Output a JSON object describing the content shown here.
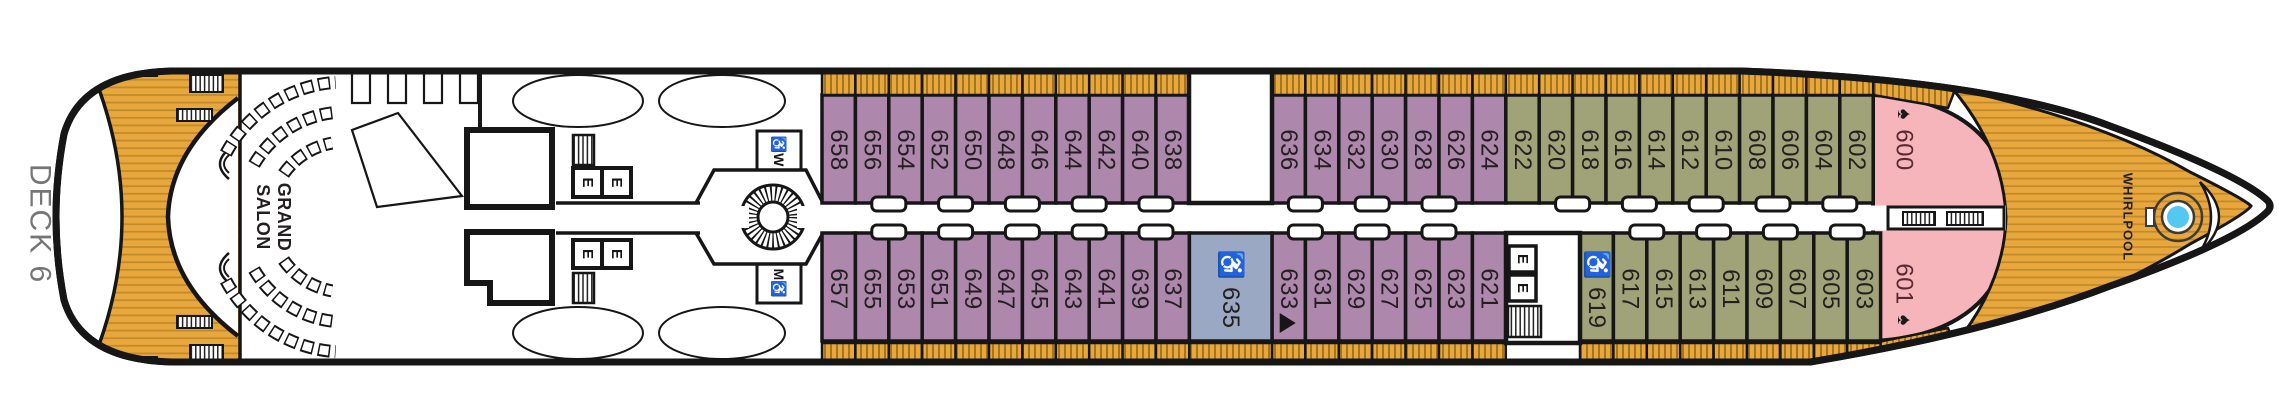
{
  "title": {
    "deck_label": "DECK 6"
  },
  "venues": {
    "grand_salon_line1": "GRAND",
    "grand_salon_line2": "SALON",
    "whirlpool": "WHIRLPOOL"
  },
  "facilities": {
    "elevator_label": "E",
    "restroom_women_label": "♿W",
    "restroom_men_label": "M♿",
    "accessible_icon": "♿",
    "spade_icon": "♠"
  },
  "colors": {
    "verandah": "#ad87ac",
    "deluxe": "#a0a377",
    "accessible": "#9aa8c4",
    "owners": "#f6b5bb",
    "teak": "#e8a73c",
    "teak_hatch": "#a3761e",
    "teak_plank": "#c08a2a",
    "whirlpool_water": "#54c8f0",
    "outline": "#161616",
    "deck_text": "#757575",
    "owners_text": "#5b2730",
    "cabin_text": "#231f20"
  },
  "cabins": {
    "top": [
      {
        "number": "658",
        "category": "verandah"
      },
      {
        "number": "656",
        "category": "verandah"
      },
      {
        "number": "654",
        "category": "verandah"
      },
      {
        "number": "652",
        "category": "verandah"
      },
      {
        "number": "650",
        "category": "verandah"
      },
      {
        "number": "648",
        "category": "verandah"
      },
      {
        "number": "646",
        "category": "verandah"
      },
      {
        "number": "644",
        "category": "verandah"
      },
      {
        "number": "642",
        "category": "verandah"
      },
      {
        "number": "640",
        "category": "verandah"
      },
      {
        "number": "638",
        "category": "verandah"
      },
      {
        "number": "636",
        "category": "verandah"
      },
      {
        "number": "634",
        "category": "verandah"
      },
      {
        "number": "632",
        "category": "verandah"
      },
      {
        "number": "630",
        "category": "verandah"
      },
      {
        "number": "628",
        "category": "verandah"
      },
      {
        "number": "626",
        "category": "verandah"
      },
      {
        "number": "624",
        "category": "verandah"
      },
      {
        "number": "622",
        "category": "deluxe"
      },
      {
        "number": "620",
        "category": "deluxe"
      },
      {
        "number": "618",
        "category": "deluxe"
      },
      {
        "number": "616",
        "category": "deluxe"
      },
      {
        "number": "614",
        "category": "deluxe"
      },
      {
        "number": "612",
        "category": "deluxe"
      },
      {
        "number": "610",
        "category": "deluxe"
      },
      {
        "number": "608",
        "category": "deluxe"
      },
      {
        "number": "606",
        "category": "deluxe"
      },
      {
        "number": "604",
        "category": "deluxe"
      },
      {
        "number": "602",
        "category": "deluxe"
      },
      {
        "number": "600",
        "category": "owners",
        "spade": true
      }
    ],
    "bottom": [
      {
        "number": "657",
        "category": "verandah"
      },
      {
        "number": "655",
        "category": "verandah"
      },
      {
        "number": "653",
        "category": "verandah"
      },
      {
        "number": "651",
        "category": "verandah"
      },
      {
        "number": "649",
        "category": "verandah"
      },
      {
        "number": "647",
        "category": "verandah"
      },
      {
        "number": "645",
        "category": "verandah"
      },
      {
        "number": "643",
        "category": "verandah"
      },
      {
        "number": "641",
        "category": "verandah"
      },
      {
        "number": "639",
        "category": "verandah"
      },
      {
        "number": "637",
        "category": "verandah"
      },
      {
        "number": "635",
        "category": "accessible",
        "accessible": true
      },
      {
        "number": "633",
        "category": "verandah",
        "marker": true
      },
      {
        "number": "631",
        "category": "verandah"
      },
      {
        "number": "629",
        "category": "verandah"
      },
      {
        "number": "627",
        "category": "verandah"
      },
      {
        "number": "625",
        "category": "verandah"
      },
      {
        "number": "623",
        "category": "verandah"
      },
      {
        "number": "621",
        "category": "verandah"
      },
      {
        "number": "619",
        "category": "deluxe",
        "accessible": true
      },
      {
        "number": "617",
        "category": "deluxe"
      },
      {
        "number": "615",
        "category": "deluxe"
      },
      {
        "number": "613",
        "category": "deluxe"
      },
      {
        "number": "611",
        "category": "deluxe"
      },
      {
        "number": "609",
        "category": "deluxe"
      },
      {
        "number": "607",
        "category": "deluxe"
      },
      {
        "number": "605",
        "category": "deluxe"
      },
      {
        "number": "603",
        "category": "deluxe"
      },
      {
        "number": "601",
        "category": "owners",
        "spade": true
      }
    ]
  }
}
